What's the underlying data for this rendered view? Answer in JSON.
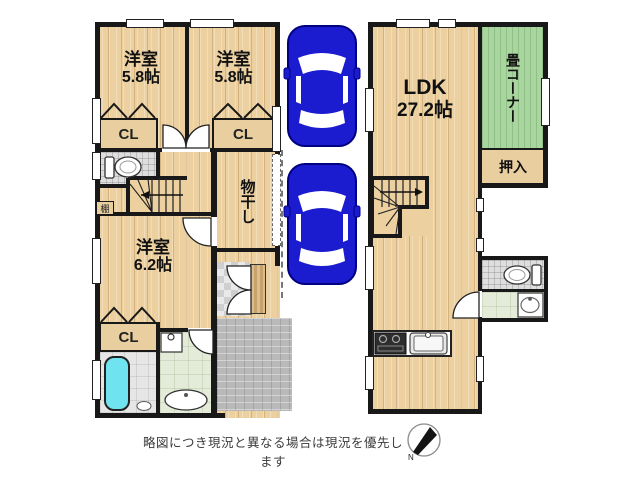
{
  "caption": "略図につき現況と異なる場合は現況を優先します",
  "compass": {
    "label": "N"
  },
  "floor1": {
    "bedroom1": {
      "name": "洋室",
      "size": "5.8帖"
    },
    "bedroom2": {
      "name": "洋室",
      "size": "5.8帖"
    },
    "bedroom3": {
      "name": "洋室",
      "size": "6.2帖"
    },
    "closet1": {
      "label": "CL"
    },
    "closet2": {
      "label": "CL"
    },
    "closet3": {
      "label": "CL"
    },
    "drying_room": {
      "label": "物干し"
    },
    "shelf": {
      "label": "棚"
    }
  },
  "floor2": {
    "ldk": {
      "name": "LDK",
      "size": "27.2帖"
    },
    "tatami_corner": {
      "label": "畳コーナー"
    },
    "oshiire": {
      "label": "押入"
    }
  },
  "colors": {
    "wood_floor": "#ecd0a0",
    "tatami_green": "#a9d59e",
    "car_blue": "#1b1bd0",
    "bathtub_cyan": "#6fe3ef",
    "wall_black": "#181818",
    "washroom_green": "#e4ebd8"
  }
}
